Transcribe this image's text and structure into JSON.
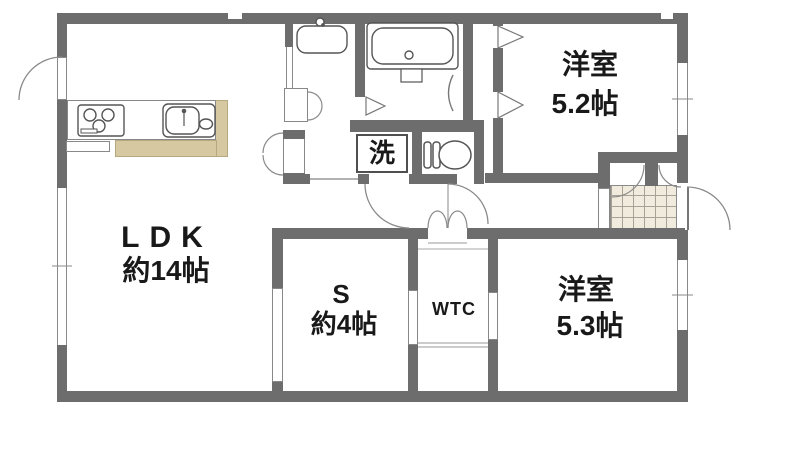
{
  "rooms": {
    "ldk": {
      "name": "LDK",
      "size": "約14帖"
    },
    "bedroom1": {
      "name": "洋室",
      "size": "5.2帖"
    },
    "bedroom2": {
      "name": "洋室",
      "size": "5.3帖"
    },
    "service": {
      "name": "S",
      "size": "約4帖"
    },
    "wtc": {
      "name": "WTC"
    },
    "laundry": {
      "name": "洗"
    }
  },
  "colors": {
    "wall": "#6d6d6d",
    "counter_accent": "#d6c8a0",
    "entry_tile": "#f0ebdc",
    "text": "#191919",
    "background": "#ffffff"
  }
}
